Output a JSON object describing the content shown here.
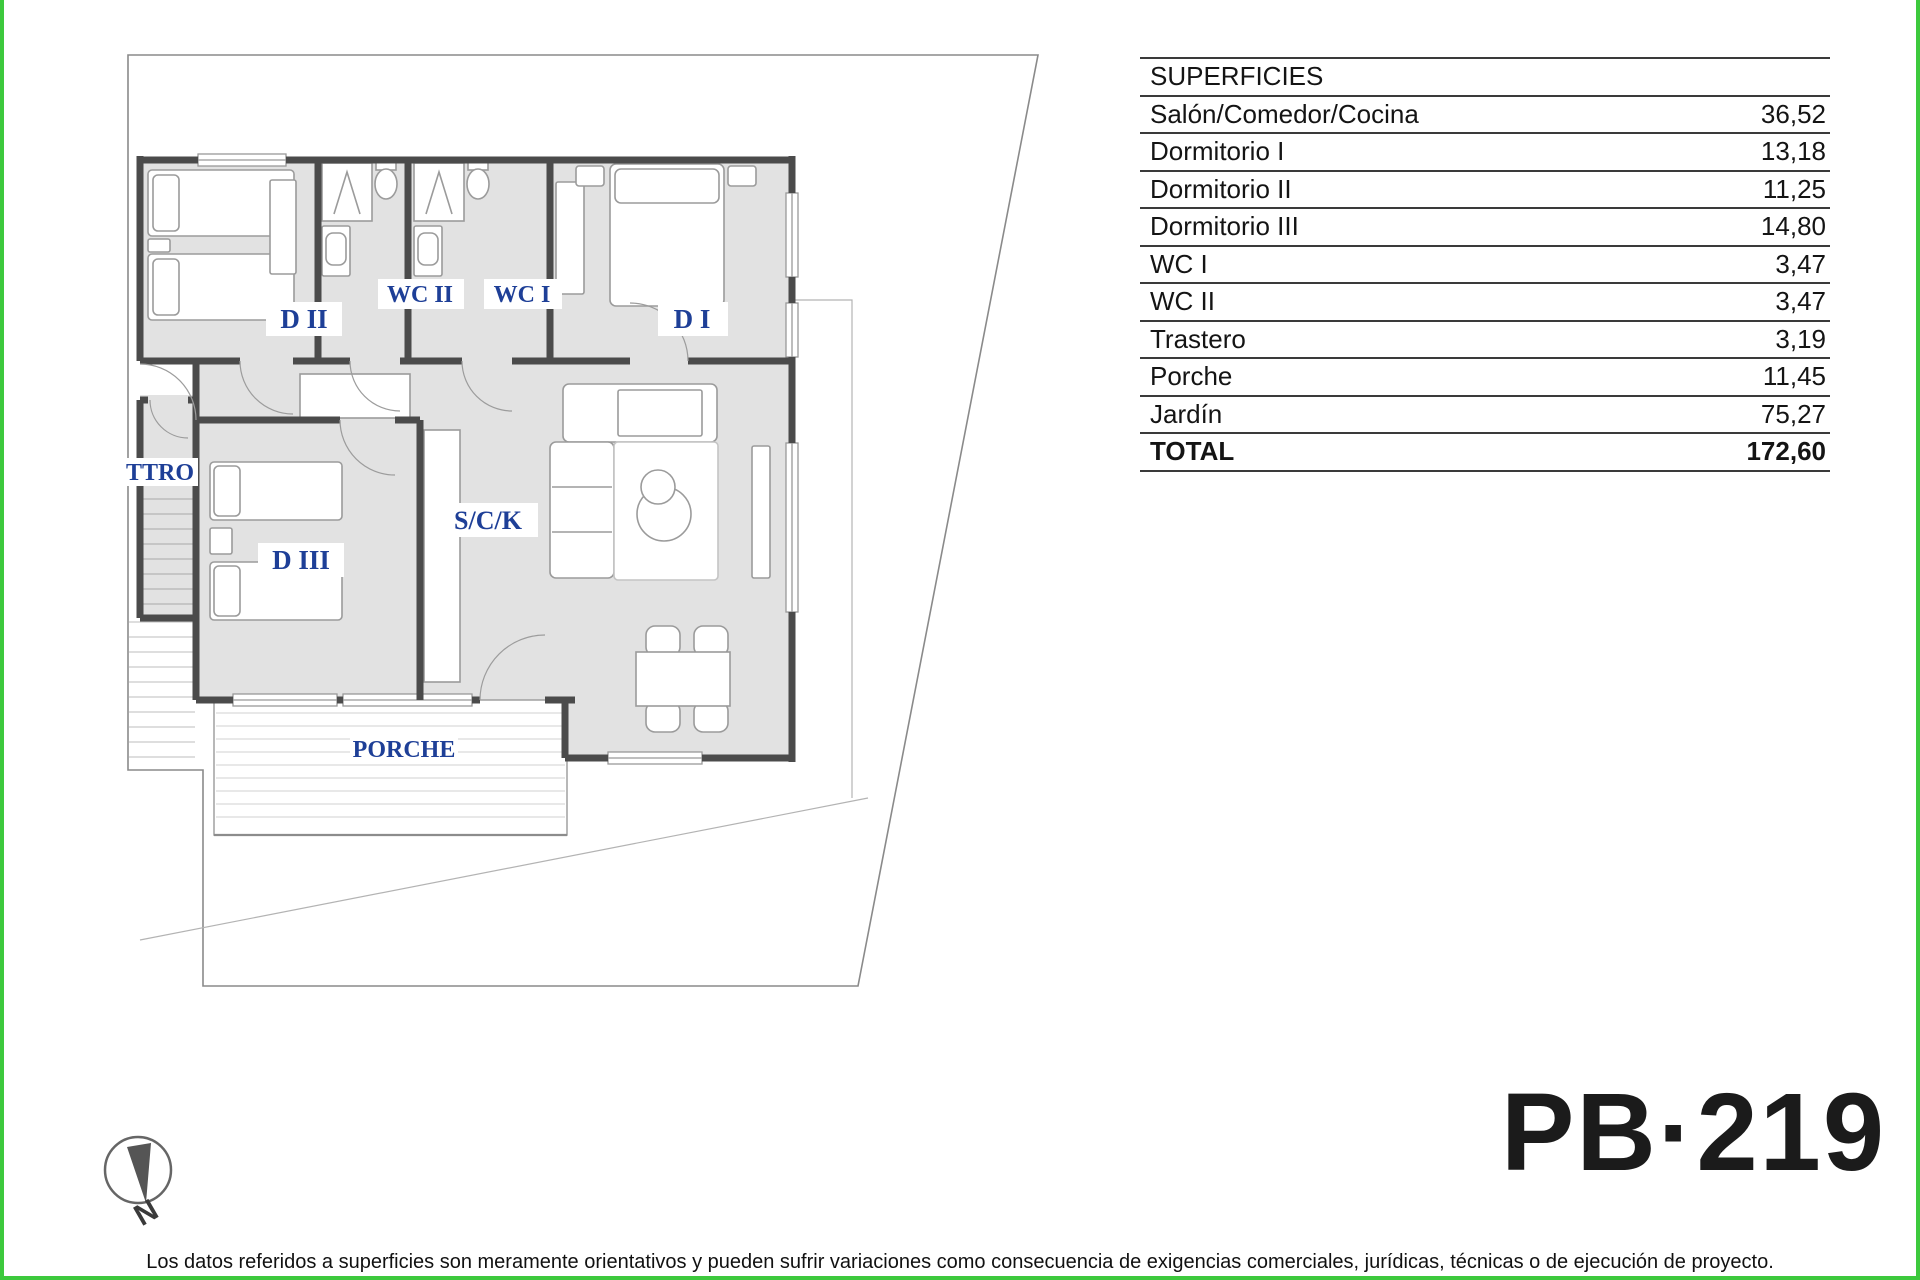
{
  "page": {
    "border_color": "#3dc93d",
    "wall_color": "#4b4b4b",
    "room_fill": "#e2e2e2",
    "label_color": "#1e3f97"
  },
  "surfaces": {
    "header": "SUPERFICIES",
    "rows": [
      {
        "name": "Salón/Comedor/Cocina",
        "value": "36,52"
      },
      {
        "name": "Dormitorio I",
        "value": "13,18"
      },
      {
        "name": "Dormitorio II",
        "value": "11,25"
      },
      {
        "name": "Dormitorio III",
        "value": "14,80"
      },
      {
        "name": "WC I",
        "value": "3,47"
      },
      {
        "name": "WC II",
        "value": "3,47"
      },
      {
        "name": "Trastero",
        "value": "3,19"
      },
      {
        "name": "Porche",
        "value": "11,45"
      },
      {
        "name": "Jardín",
        "value": "75,27"
      }
    ],
    "total": {
      "name": "TOTAL",
      "value": "172,60"
    }
  },
  "plan": {
    "rooms": [
      {
        "label": "D II"
      },
      {
        "label": "WC II"
      },
      {
        "label": "WC I"
      },
      {
        "label": "D I"
      },
      {
        "label": "TTRO"
      },
      {
        "label": "D III"
      },
      {
        "label": "S/C/K"
      },
      {
        "label": "PORCHE"
      }
    ]
  },
  "compass": {
    "label": "N"
  },
  "plan_code": "PB·219",
  "disclaimer": "Los datos referidos a superficies son meramente orientativos y pueden sufrir variaciones como consecuencia de exigencias comerciales, jurídicas, técnicas o de ejecución de proyecto."
}
